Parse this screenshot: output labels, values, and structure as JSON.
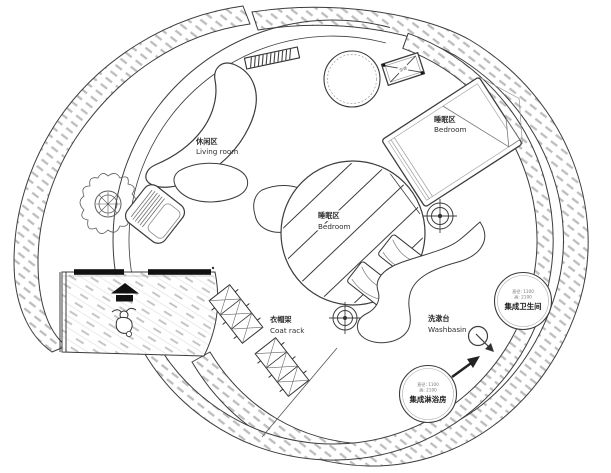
{
  "plan": {
    "areas": {
      "living": {
        "zh": "休闲区",
        "en": "Living room"
      },
      "bedroom_upper": {
        "zh": "睡眠区",
        "en": "Bedroom"
      },
      "bedroom_center": {
        "zh": "睡眠区",
        "en": "Bedroom"
      },
      "washbasin": {
        "zh": "洗漱台",
        "en": "Washbasin"
      },
      "coat_rack": {
        "zh": "衣帽架",
        "en": "Coat rack"
      }
    },
    "pods": {
      "toilet": {
        "dim_diameter": "直径: 1100",
        "dim_height": "高: 2100",
        "name": "集成卫生间"
      },
      "shower": {
        "dim_diameter": "直径: 1100",
        "dim_height": "高: 2100",
        "name": "集成淋浴房"
      }
    },
    "equipment": {
      "ac_unit": "空调"
    },
    "colors": {
      "ink": "#3c3c3c",
      "wall_hatch": "#bdbdbd",
      "floor_hatch": "#c6c6c6",
      "paper": "#ffffff",
      "entry_marker": "#111111"
    }
  }
}
